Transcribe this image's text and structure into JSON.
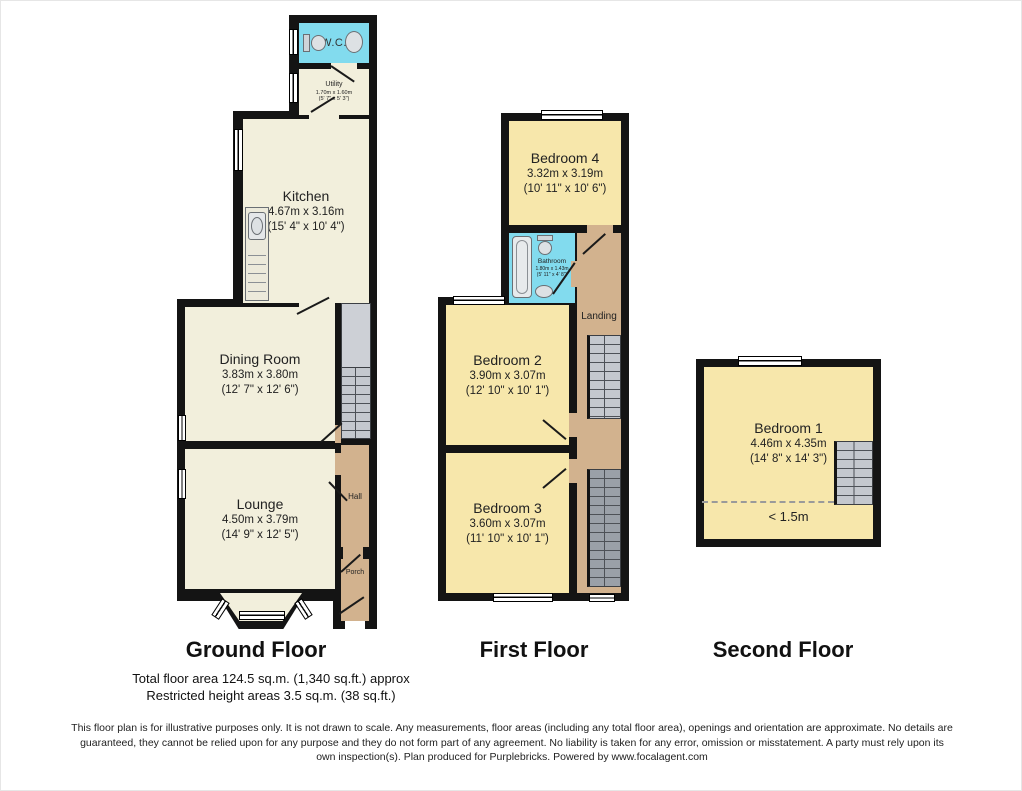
{
  "floors": {
    "ground": {
      "label": "Ground Floor",
      "rooms": {
        "wc": {
          "name": "W.C."
        },
        "utility": {
          "name": "Utility",
          "metric": "1.70m x 1.60m",
          "imperial": "(5' 7\" x 5' 3\")"
        },
        "kitchen": {
          "name": "Kitchen",
          "metric": "4.67m x 3.16m",
          "imperial": "(15' 4\" x 10' 4\")"
        },
        "dining_room": {
          "name": "Dining Room",
          "metric": "3.83m x 3.80m",
          "imperial": "(12' 7\" x 12' 6\")"
        },
        "lounge": {
          "name": "Lounge",
          "metric": "4.50m x 3.79m",
          "imperial": "(14' 9\" x 12' 5\")"
        },
        "hall": {
          "name": "Hall"
        },
        "porch": {
          "name": "Porch"
        }
      }
    },
    "first": {
      "label": "First Floor",
      "rooms": {
        "bedroom4": {
          "name": "Bedroom 4",
          "metric": "3.32m x 3.19m",
          "imperial": "(10' 11\" x 10' 6\")"
        },
        "bathroom": {
          "name": "Bathroom",
          "metric": "1.80m x 1.43m",
          "imperial": "(5' 11\" x 4' 8\")"
        },
        "landing": {
          "name": "Landing"
        },
        "bedroom2": {
          "name": "Bedroom 2",
          "metric": "3.90m x 3.07m",
          "imperial": "(12' 10\" x 10' 1\")"
        },
        "bedroom3": {
          "name": "Bedroom 3",
          "metric": "3.60m x 3.07m",
          "imperial": "(11' 10\" x 10' 1\")"
        }
      }
    },
    "second": {
      "label": "Second Floor",
      "rooms": {
        "bedroom1": {
          "name": "Bedroom 1",
          "metric": "4.46m x 4.35m",
          "imperial": "(14' 8\" x 14' 3\")"
        },
        "restricted_note": "< 1.5m"
      }
    }
  },
  "summary": {
    "total_area": "Total floor area 124.5 sq.m. (1,340 sq.ft.) approx",
    "restricted_height": "Restricted height areas 3.5 sq.m. (38 sq.ft.)"
  },
  "disclaimer": "This floor plan is for illustrative purposes only. It is not drawn to scale. Any measurements, floor areas (including any total floor area), openings and orientation are approximate. No details are guaranteed, they cannot be relied upon for any purpose and they do not form part of any agreement. No liability is taken for any error, omission or misstatement. A party must rely upon its own inspection(s). Plan produced for Purplebricks. Powered by www.focalagent.com",
  "colors": {
    "wall": "#141414",
    "ground_room": "#f2efdc",
    "bedroom": "#f7e7ab",
    "wet_room": "#82dbee",
    "circulation": "#d2b28e",
    "stairs": "#c4c8ce"
  }
}
